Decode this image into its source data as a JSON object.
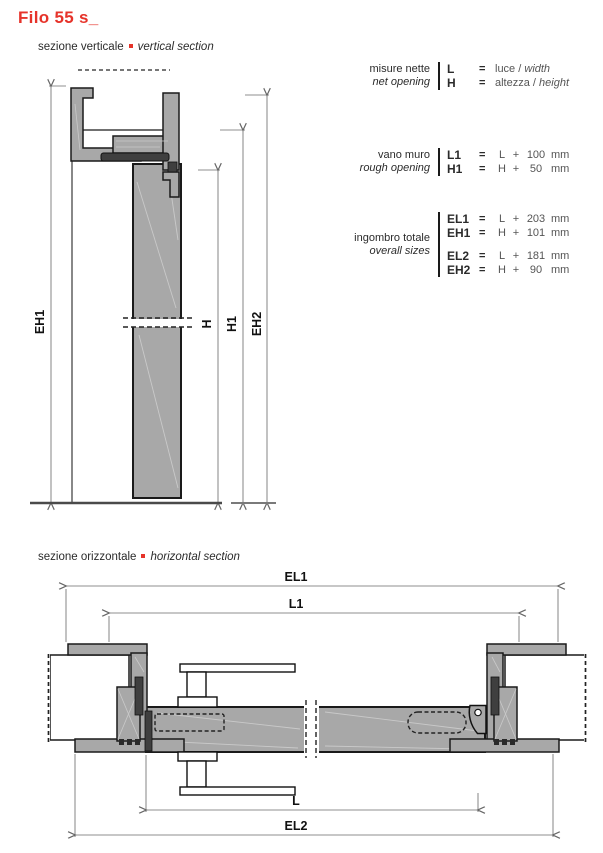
{
  "page": {
    "title": "Filo 55 s_"
  },
  "colors": {
    "accent_red": "#e6332a",
    "profile_gray": "#a8a8a8",
    "dark_gray": "#3f3f3f",
    "outline": "#1a1a1a",
    "dimension_gray": "#8f8f8f"
  },
  "vertical_section": {
    "label_it": "sezione verticale",
    "label_en": "vertical section",
    "dims": {
      "eh1": "EH1",
      "h": "H",
      "h1": "H1",
      "eh2": "EH2"
    }
  },
  "horizontal_section": {
    "label_it": "sezione orizzontale",
    "label_en": "horizontal section",
    "dims": {
      "el1": "EL1",
      "l1": "L1",
      "l": "L",
      "el2": "EL2"
    }
  },
  "measures": {
    "eq_sign": "=",
    "sep": "/",
    "groups": [
      {
        "label_it": "misure nette",
        "label_en": "net opening",
        "rows": [
          {
            "symbol": "L",
            "value_it": "luce",
            "value_en": "width"
          },
          {
            "symbol": "H",
            "value_it": "altezza",
            "value_en": "height"
          }
        ]
      },
      {
        "label_it": "vano muro",
        "label_en": "rough opening",
        "rows": [
          {
            "symbol": "L1",
            "base": "L",
            "op": "+",
            "amount": "100",
            "unit": "mm"
          },
          {
            "symbol": "H1",
            "base": "H",
            "op": "+",
            "amount": "50",
            "unit": "mm"
          }
        ]
      },
      {
        "label_it": "ingombro totale",
        "label_en": "overall sizes",
        "rows": [
          {
            "symbol": "EL1",
            "base": "L",
            "op": "+",
            "amount": "203",
            "unit": "mm"
          },
          {
            "symbol": "EH1",
            "base": "H",
            "op": "+",
            "amount": "101",
            "unit": "mm"
          },
          {
            "symbol": "EL2",
            "base": "L",
            "op": "+",
            "amount": "181",
            "unit": "mm"
          },
          {
            "symbol": "EH2",
            "base": "H",
            "op": "+",
            "amount": "90",
            "unit": "mm"
          }
        ]
      }
    ]
  }
}
